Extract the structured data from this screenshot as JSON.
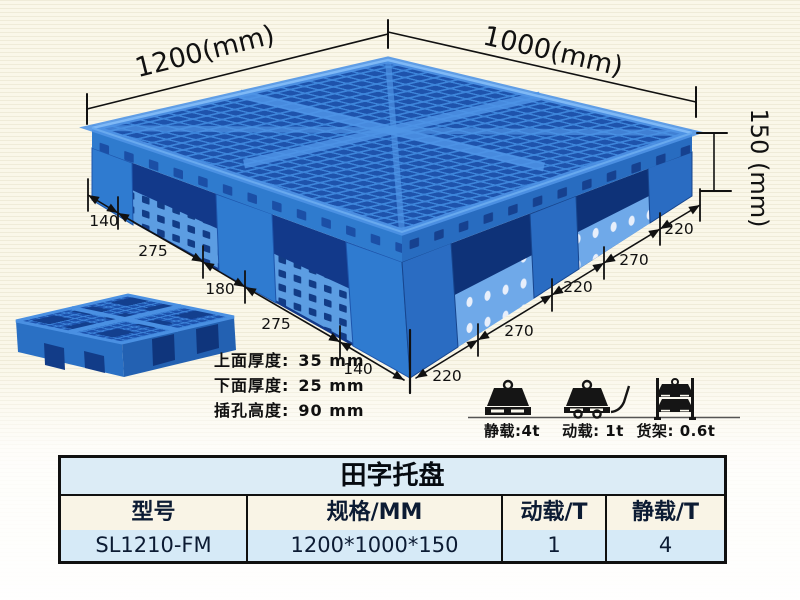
{
  "annotations": {
    "length": "1200(mm)",
    "width": "1000(mm)",
    "height": "150 (mm)",
    "left_edge_dims": [
      "140",
      "275",
      "180",
      "275",
      "140"
    ],
    "right_edge_dims": [
      "220",
      "270",
      "220",
      "270",
      "220"
    ]
  },
  "specs": {
    "rows": [
      {
        "label": "上面厚度:",
        "value": "35 mm"
      },
      {
        "label": "下面厚度:",
        "value": "25 mm"
      },
      {
        "label": "插孔高度:",
        "value": "90 mm"
      }
    ]
  },
  "capacity": {
    "static_label": "静载:4t",
    "dynamic_label": "动载: 1t",
    "rack_label": "货架: 0.6t"
  },
  "table": {
    "title": "田字托盘",
    "headers": [
      "型号",
      "规格/MM",
      "动载/T",
      "静载/T"
    ],
    "rows": [
      [
        "SL1210-FM",
        "1200*1000*150",
        "1",
        "4"
      ]
    ]
  },
  "colors": {
    "pallet_blue": "#2f7bd0",
    "pallet_dark_hole": "#1e53ac",
    "pallet_light_runner": "#5c9de2",
    "annotation_black": "#111111",
    "table_title_bg": "#dcecf6",
    "table_header_bg": "#f9f4e6",
    "table_row_bg": "#d6eaf7",
    "background_cream": "#faf7e9"
  }
}
